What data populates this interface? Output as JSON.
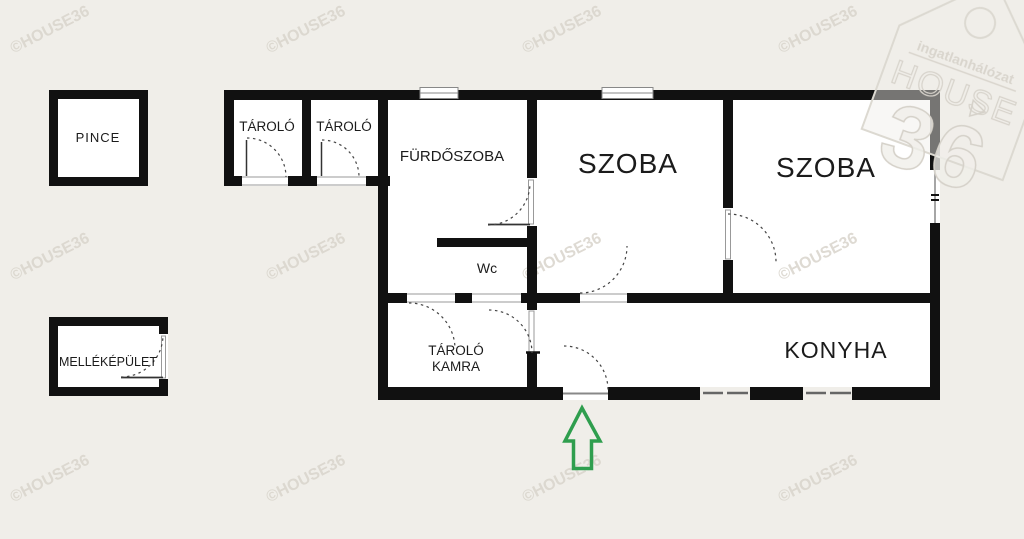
{
  "plan": {
    "rooms": {
      "pince": "PINCE",
      "mellekepulet": "MELLÉKÉPÜLET",
      "tarolo_left": "TÁROLÓ",
      "tarolo_right": "TÁROLÓ",
      "furdoszoba": "FÜRDŐSZOBA",
      "wc": "Wc",
      "szoba_left": "SZOBA",
      "szoba_right": "SZOBA",
      "tarolo_kamra_line1": "TÁROLÓ",
      "tarolo_kamra_line2": "KAMRA",
      "konyha": "KONYHA"
    },
    "entrance_arrow_color": "#2f9e4e",
    "wall_color": "#111111"
  },
  "watermark": {
    "text": "©HOUSE36",
    "color": "#d8d4cb"
  },
  "logo": {
    "line1": "ingatlanhálózat",
    "line2": "HOUSE",
    "line3": "36",
    "color": "#d9d5cd"
  }
}
